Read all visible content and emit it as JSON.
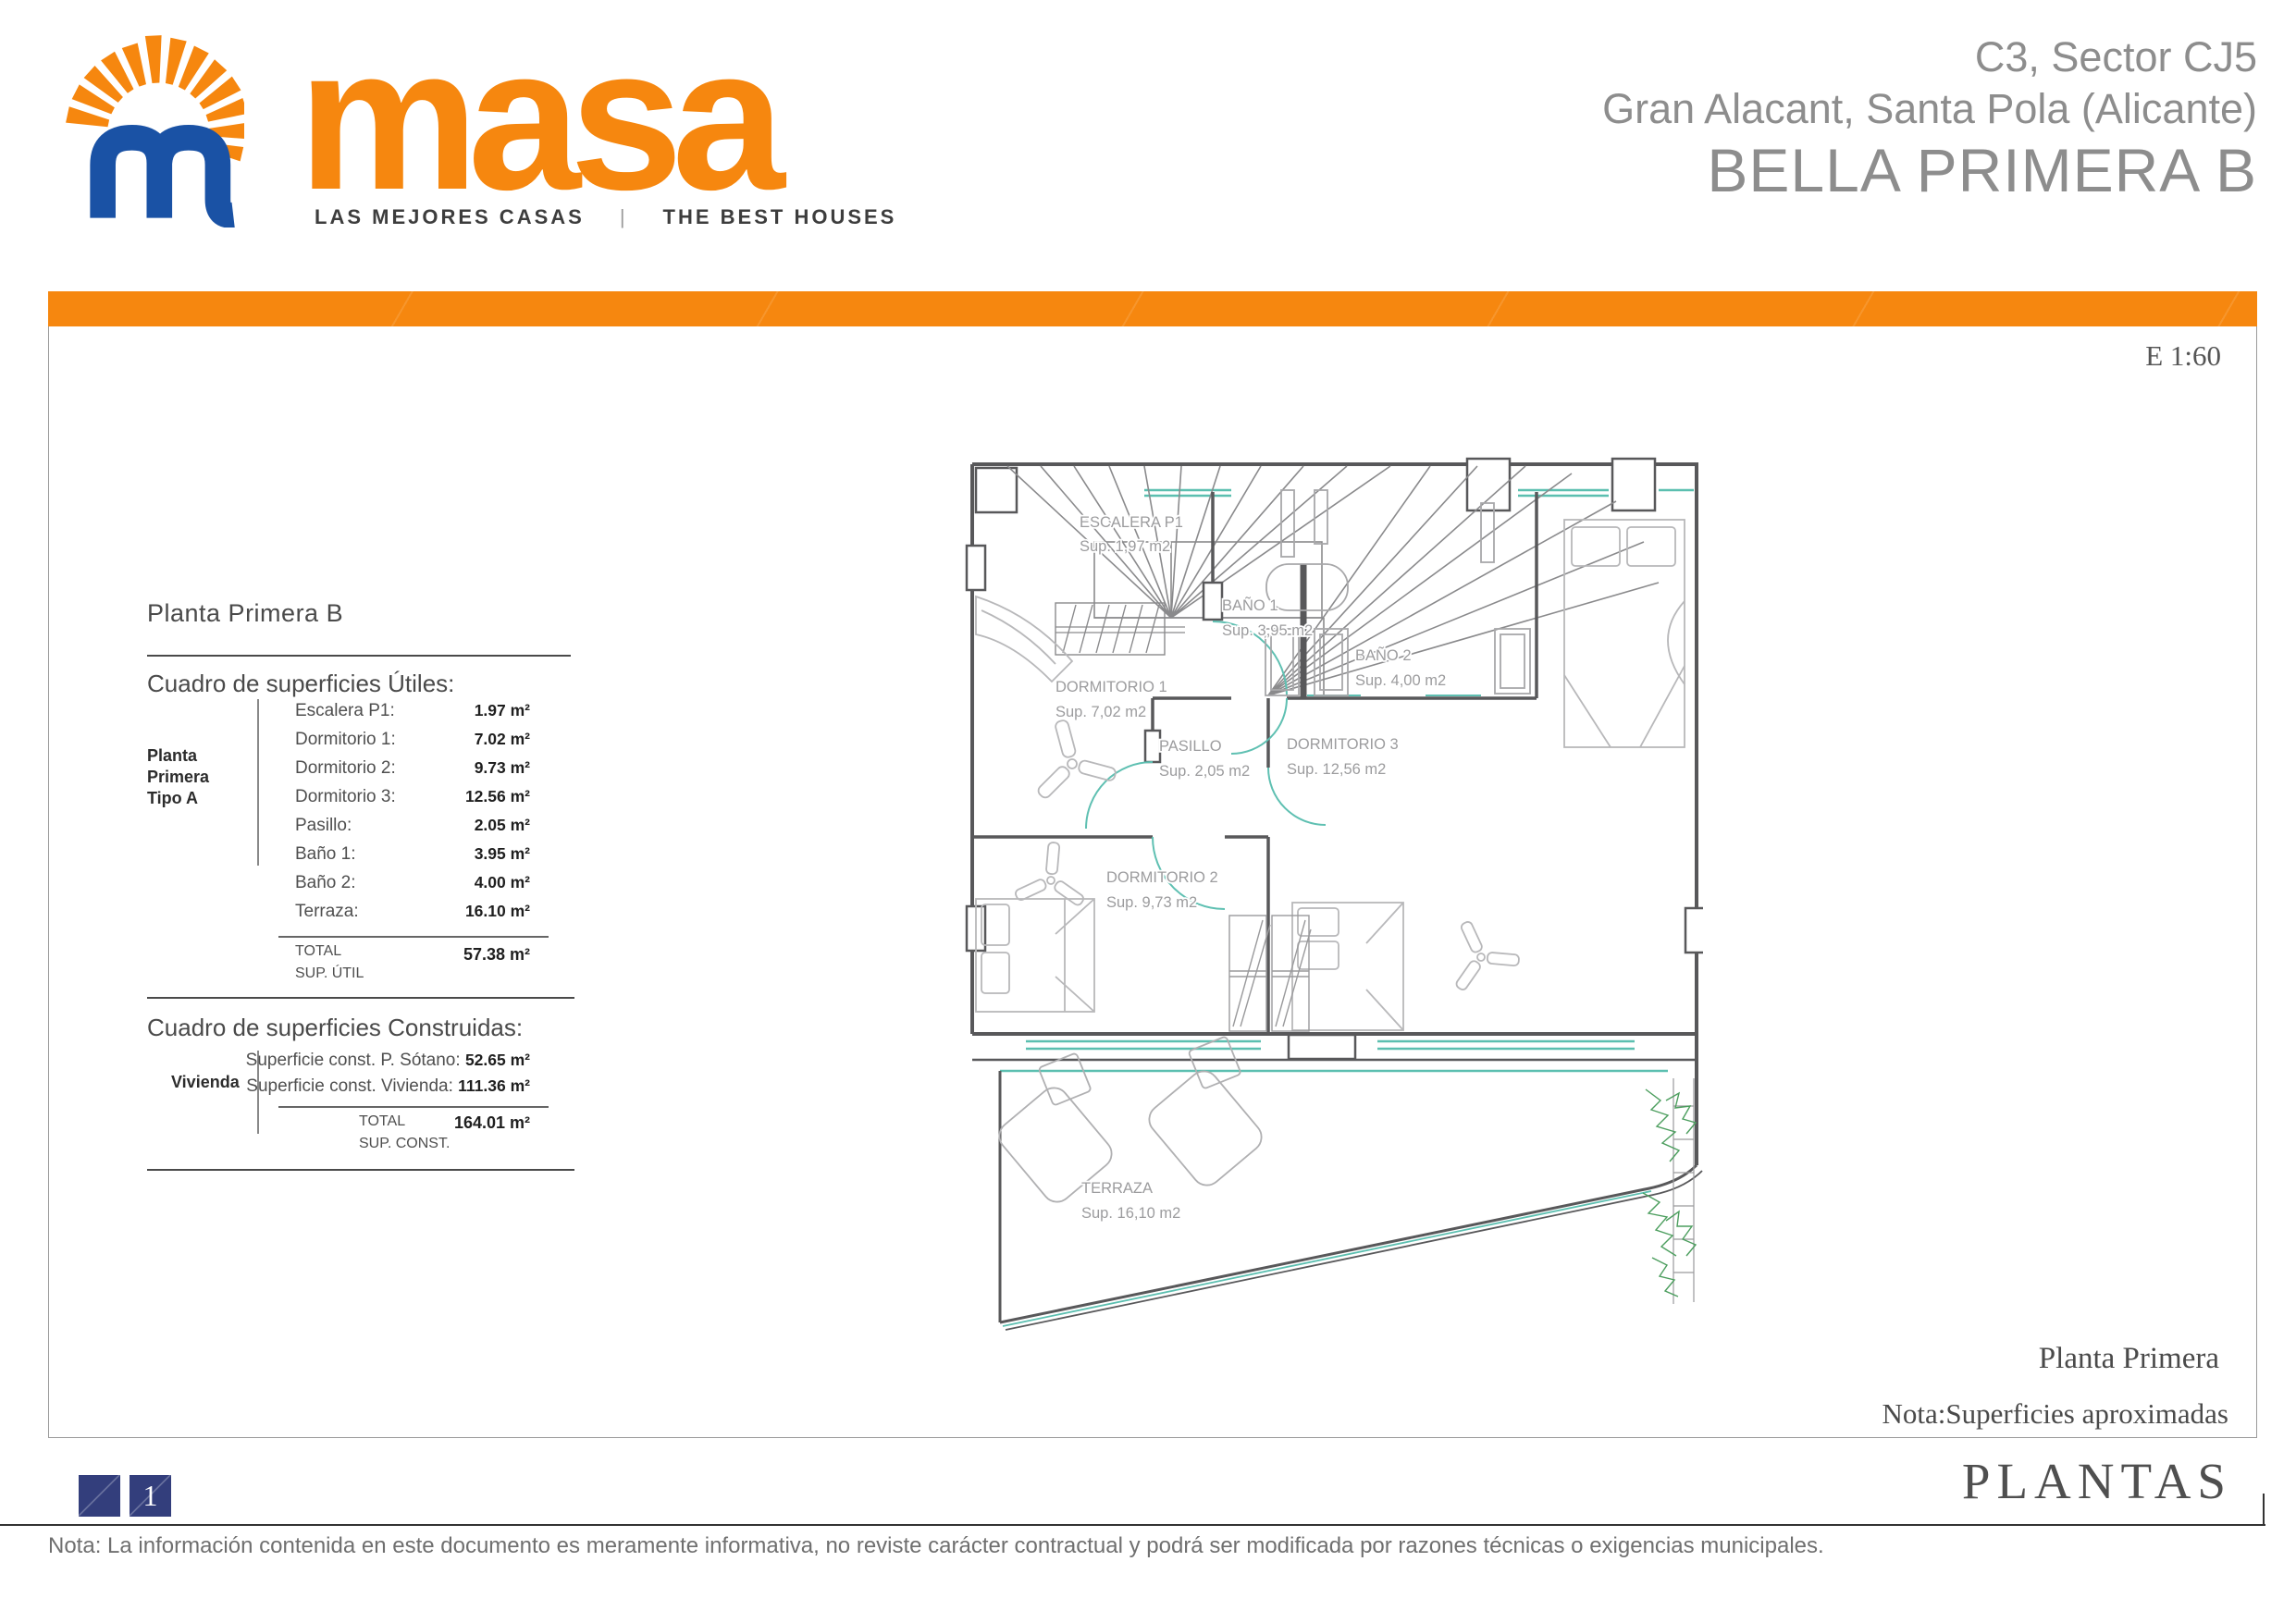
{
  "header": {
    "logo": {
      "brand": "masa",
      "tagline_es": "LAS MEJORES CASAS",
      "tagline_sep": "|",
      "tagline_en": "THE BEST HOUSES"
    },
    "project": {
      "line1": "C3, Sector CJ5",
      "line2": "Gran Alacant, Santa Pola (Alicante)",
      "line3": "BELLA PRIMERA B"
    }
  },
  "sheet": {
    "scale": "E 1:60",
    "plan_title": "Planta Primera",
    "approx_note": "Nota:Superficies aproximadas",
    "section_title": "PLANTAS",
    "page_number": "1",
    "footer_note": "Nota: La información contenida en este documento es meramente informativa, no reviste carácter contractual y podrá ser modificada por razones técnicas o exigencias municipales."
  },
  "panel": {
    "title": "Planta Primera B",
    "useful": {
      "heading": "Cuadro de superficies Útiles:",
      "group_line1": "Planta Primera",
      "group_line2": "Tipo A",
      "rows": [
        {
          "label": "Escalera P1:",
          "value": "1.97 m²"
        },
        {
          "label": "Dormitorio 1:",
          "value": "7.02 m²"
        },
        {
          "label": "Dormitorio 2:",
          "value": "9.73 m²"
        },
        {
          "label": "Dormitorio 3:",
          "value": "12.56 m²"
        },
        {
          "label": "Pasillo:",
          "value": "2.05 m²"
        },
        {
          "label": "Baño 1:",
          "value": "3.95 m²"
        },
        {
          "label": "Baño 2:",
          "value": "4.00 m²"
        },
        {
          "label": "Terraza:",
          "value": "16.10 m²"
        }
      ],
      "total_label": "TOTAL",
      "total_sublabel": "SUP. ÚTIL",
      "total_value": "57.38 m²"
    },
    "built": {
      "heading": "Cuadro de superficies Construidas:",
      "group_label": "Vivienda",
      "rows": [
        {
          "label": "Superficie const. P. Sótano:",
          "value": "52.65 m²"
        },
        {
          "label": "Superficie const. Vivienda:",
          "value": "111.36 m²"
        }
      ],
      "total_label": "TOTAL",
      "total_sublabel": "SUP. CONST.",
      "total_value": "164.01 m²"
    }
  },
  "plan": {
    "rooms": [
      {
        "name": "ESCALERA P1",
        "area": "Sup. 1,97 m2"
      },
      {
        "name": "BAÑO 1",
        "area": "Sup. 3,95 m2"
      },
      {
        "name": "BAÑO 2",
        "area": "Sup. 4,00 m2"
      },
      {
        "name": "DORMITORIO 1",
        "area": "Sup. 7,02 m2"
      },
      {
        "name": "PASILLO",
        "area": "Sup. 2,05 m2"
      },
      {
        "name": "DORMITORIO 3",
        "area": "Sup. 12,56 m2"
      },
      {
        "name": "DORMITORIO 2",
        "area": "Sup. 9,73 m2"
      },
      {
        "name": "TERRAZA",
        "area": "Sup. 16,10 m2"
      }
    ]
  },
  "colors": {
    "orange": "#F6870F",
    "blue": "#1A52A5",
    "navy": "#333E7C",
    "teal": "#5BBFB0",
    "plant_green": "#4C9E5E",
    "wall_gray": "#58585A"
  }
}
